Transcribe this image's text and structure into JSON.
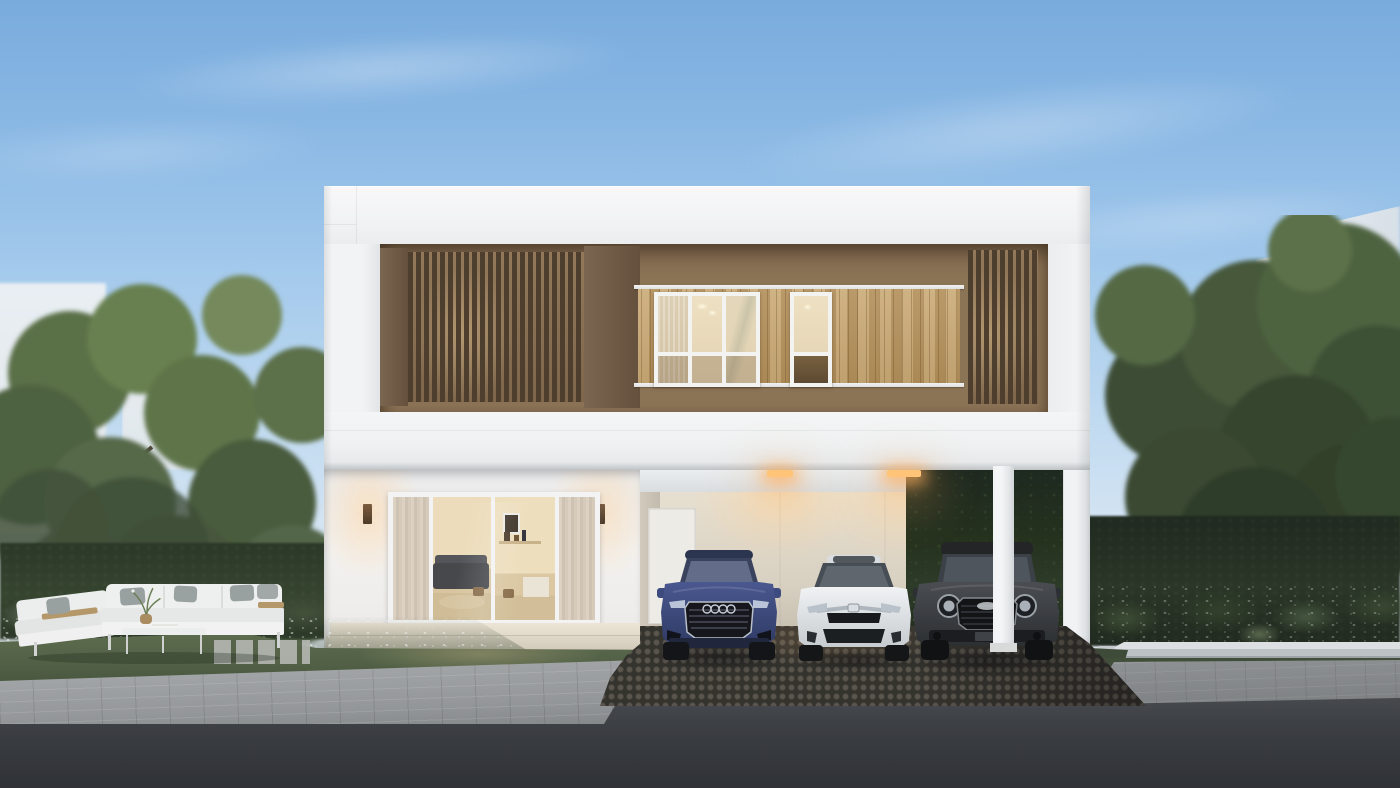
{
  "scene": {
    "type": "architectural-exterior-rendering",
    "description": "Photorealistic dusk rendering of a modern two-storey white house with brown timber-slat upper facade, lit interior windows, four-panel glass living-room doors, a carport sheltering three cars, landscaped gardens with an outdoor lounge set, gray paver sidewalk, dark cobblestone driveway and asphalt road",
    "time_of_day": "dusk"
  },
  "palette": {
    "sky_top": "#79abdd",
    "sky_horizon": "#ebeff2",
    "wall_white": "#f2f3f4",
    "wall_shadow": "#d9dcdf",
    "facade_brown": "#8b7356",
    "slat_brown": "#4e3e2d",
    "wood_plank": "#bf9f6e",
    "window_glow": "#ecdfc2",
    "carport_wall": "#ddd4c4",
    "carport_light": "#ffc478",
    "foliage_light": "#68804f",
    "foliage_dark": "#35452e",
    "hedge": "#2c3829",
    "grass": "#55644a",
    "paver_gray": "#9fa2a4",
    "cobble_dark": "#46443f",
    "asphalt": "#3a3d41",
    "curb_concrete": "#c3c8cc",
    "car_blue": "#3d4b7e",
    "car_white": "#e9ecef",
    "car_charcoal": "#3a3d40",
    "cushion_white": "#eef0ef",
    "pillow_gray": "#99a0a0",
    "table_wood": "#b5986a"
  },
  "house": {
    "storeys": 2,
    "upper_floor": {
      "finish": "recessed brown band with vertical timber slat screens",
      "slat_screens": 2,
      "cladding_band": "light timber planks with white trim rails",
      "windows": [
        {
          "id": "large-window",
          "frame": "white",
          "panes": 6,
          "lit": true
        },
        {
          "id": "narrow-window",
          "frame": "white",
          "panes": 2,
          "lit": true
        }
      ]
    },
    "ground_floor": {
      "glass_door": {
        "panels": 4,
        "frame": "white",
        "curtains": true,
        "interior": "living room with gray sofa, wall shelf, picture frame and wooden stools"
      },
      "wall_lamps": 2,
      "entry_steps": 2,
      "carport": {
        "ceiling_lights": 2,
        "interior_door": "white single door",
        "support_columns": 2,
        "back_wall": "beige"
      }
    }
  },
  "cars": [
    {
      "id": "car-blue-suv",
      "style": "SUV with four-ring grille badge",
      "color": "#3d4b7e",
      "bay": "left"
    },
    {
      "id": "car-white-sedan",
      "style": "sedan with chrome grille bar and sunroof",
      "color": "#e9ecef",
      "bay": "middle"
    },
    {
      "id": "car-charcoal-crossover",
      "style": "crossover with round headlights",
      "color": "#3a3d40",
      "bay": "right"
    }
  ],
  "landscape": {
    "left_garden": {
      "outdoor_sofa": {
        "sections": 2,
        "gray_pillows": 4,
        "coffee_table": true,
        "plant_centerpiece": true,
        "wood_side_tables": 2
      },
      "flower_bed": "white ground-cover flowers",
      "hedge": true,
      "trees": 2,
      "stepping_stones": true
    },
    "right_garden": {
      "planter_curb": "white concrete",
      "large_leaf_plants": true,
      "white_flowers": true,
      "hedge": true,
      "trees": 2
    },
    "hardscape": {
      "sidewalk": "gray pavers",
      "driveway": "dark cobblestone",
      "road": "asphalt"
    }
  },
  "background": {
    "neighbor_buildings": 4,
    "clouds": "thin diagonal streaks"
  }
}
